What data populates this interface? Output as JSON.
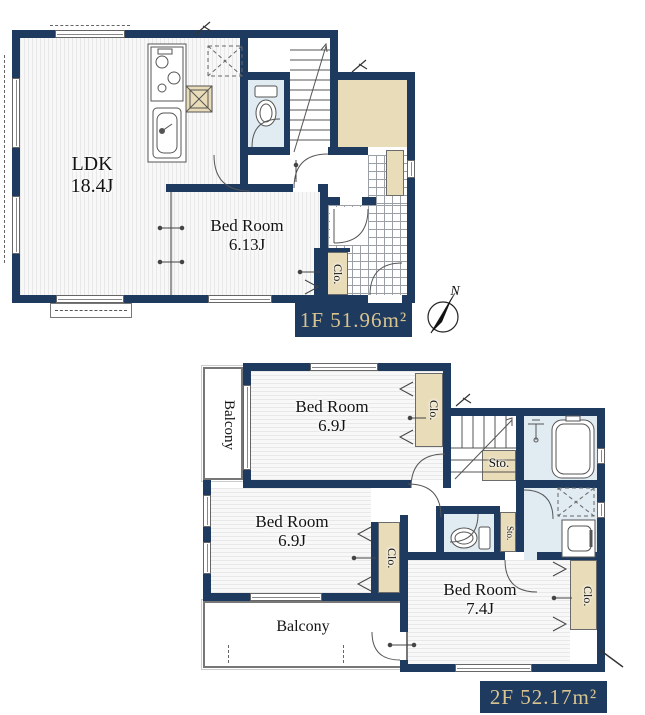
{
  "floor1": {
    "area_label": "1F 51.96m²",
    "rooms": {
      "ldk": {
        "name": "LDK",
        "size": "18.4J"
      },
      "bedroom": {
        "name": "Bed Room",
        "size": "6.13J"
      },
      "closet": {
        "name": "Clo."
      }
    }
  },
  "floor2": {
    "area_label": "2F 52.17m²",
    "rooms": {
      "bedroom_north": {
        "name": "Bed Room",
        "size": "6.9J"
      },
      "bedroom_west": {
        "name": "Bed Room",
        "size": "6.9J"
      },
      "bedroom_south": {
        "name": "Bed Room",
        "size": "7.4J"
      },
      "balcony_west": {
        "name": "Balcony"
      },
      "balcony_south": {
        "name": "Balcony"
      },
      "closet_north": {
        "name": "Clo."
      },
      "closet_west": {
        "name": "Clo."
      },
      "closet_south": {
        "name": "Clo."
      },
      "storage_hall": {
        "name": "Sto."
      },
      "storage_small": {
        "name": "Sto."
      }
    }
  },
  "compass": {
    "north_label": "N"
  },
  "colors": {
    "wall": "#1e3a5f",
    "area_text": "#d9c48f",
    "closet_fill": "#e9dcb8",
    "wet_area_fill": "#e0ebf2"
  }
}
